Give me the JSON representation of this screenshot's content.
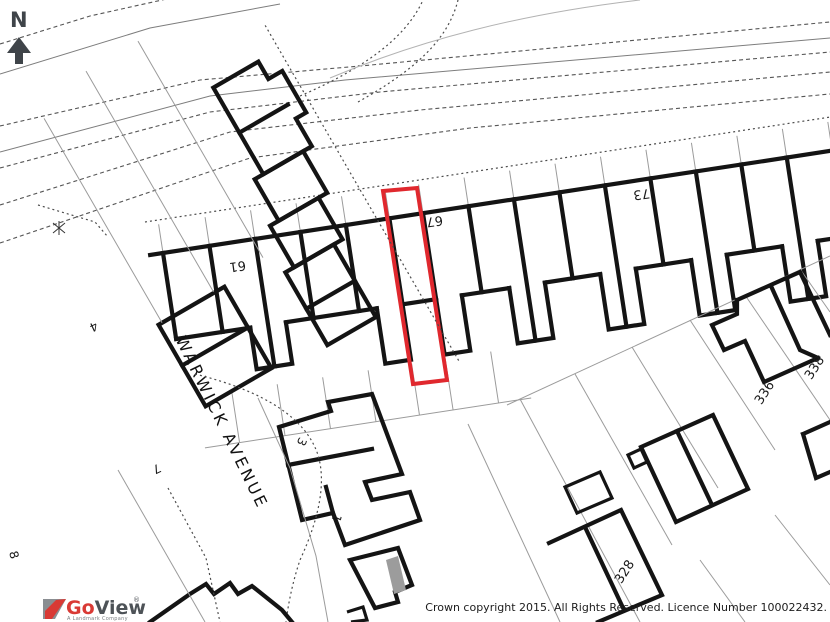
{
  "map": {
    "north_label": "N",
    "street": "WARWICK AVENUE",
    "house_numbers": {
      "n61": "61",
      "n67": "67",
      "n73": "73",
      "n4": "4",
      "n7": "7",
      "n8": "8",
      "n3": "3",
      "n1": "1",
      "n328": "328",
      "n336": "336",
      "n338": "338"
    }
  },
  "branding": {
    "logo_go": "Go",
    "logo_view": "View",
    "logo_reg": "®",
    "logo_tagline": "A Landmark Company"
  },
  "footer": {
    "copyright": "Crown copyright 2015. All Rights Reserved. Licence Number 100022432."
  },
  "colors": {
    "highlight_red": "#e0282e",
    "building_black": "#141414",
    "parcel_grey": "#9b9b9b",
    "logo_red": "#d93a35",
    "logo_grey": "#4d5257"
  }
}
